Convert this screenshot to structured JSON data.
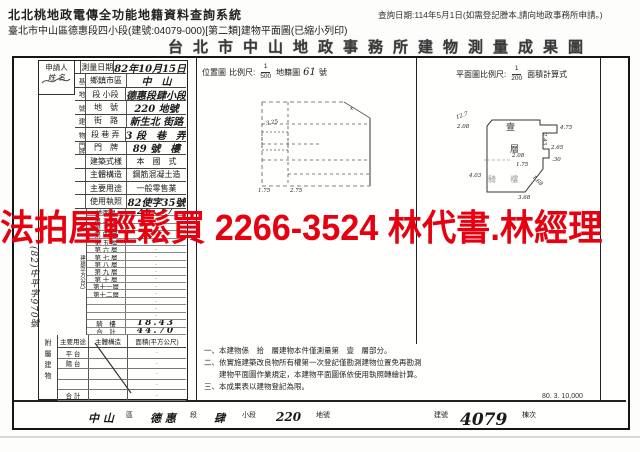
{
  "app": {
    "system_title": "北北桃地政電傳全功能地籍資料查詢系統",
    "query_date": "查詢日期:114年5月1日(如需登記謄本,請向地政事務所申請。)",
    "doc_path": "臺北市中山區德惠段四小段(建號:04079-000)[第二類]建物平面圖(已縮小列印)"
  },
  "overlay": {
    "text": "法拍屋輕鬆買 2266-3524 林代書.林經理",
    "color": "#e60010"
  },
  "document": {
    "title": "台北市中山地政事務所建物測量成果圖",
    "applicant_label": "申請人",
    "applicant_name_label": "姓 名",
    "survey_rows": [
      {
        "group": "",
        "label": "測量日期",
        "value": "82年10月15日",
        "hw": true
      },
      {
        "group": "基",
        "label": "鄉鎮市區",
        "value": "中　山",
        "hw": true
      },
      {
        "group": "地",
        "label": "段 小段",
        "value": "德惠段肆小段",
        "hw": true
      },
      {
        "group": "號",
        "label": "地　號",
        "value": "220 地號",
        "hw": true
      },
      {
        "group": "建",
        "label": "街　路",
        "value": "新生北 街路",
        "hw": true
      },
      {
        "group": "物",
        "label": "段 巷 弄",
        "value": "3 段　巷　弄",
        "hw": true
      },
      {
        "group": "門牌",
        "label": "門　牌",
        "value": "89 號　樓",
        "hw": true
      },
      {
        "group": "",
        "label": "建築式樣",
        "value": "本　國　式",
        "hw": false
      },
      {
        "group": "",
        "label": "主體構造",
        "value": "鋼筋混凝土造",
        "hw": false
      },
      {
        "group": "",
        "label": "主要用途",
        "value": "一般零售業",
        "hw": false
      },
      {
        "group": "",
        "label": "使用執照",
        "value": "82使字35號",
        "hw": true
      }
    ],
    "area_section": {
      "unit_label": "建 積(平方公尺)",
      "rows": [
        {
          "label": "地面層",
          "value": "26.27",
          "hw": true
        },
        {
          "label": "第 二 層",
          "value": "·"
        },
        {
          "label": "第 三 層",
          "value": "·"
        },
        {
          "label": "第 四 層",
          "value": "·"
        },
        {
          "label": "第 五 層",
          "value": "·"
        },
        {
          "label": "第 六 層",
          "value": "·"
        },
        {
          "label": "第 七 層",
          "value": "·"
        },
        {
          "label": "第 八 層",
          "value": "·"
        },
        {
          "label": "第 九 層",
          "value": "·"
        },
        {
          "label": "第 十 層",
          "value": "·"
        },
        {
          "label": "第十一層",
          "value": "·"
        },
        {
          "label": "第十二層",
          "value": "·"
        },
        {
          "label": "",
          "value": "·"
        },
        {
          "label": "",
          "value": "·"
        },
        {
          "label": "",
          "value": "·"
        },
        {
          "label": "騎　樓",
          "value": "18.43",
          "hw": true
        },
        {
          "label": "合　計",
          "value": "44.70",
          "hw": true
        }
      ]
    },
    "margin_note": "(82)中平字970號",
    "attachment": {
      "side_label": "附屬建物",
      "headers": [
        "主要用途",
        "主體構造",
        "面積(平方公尺)"
      ],
      "rows": [
        {
          "label": "平 台",
          "value": "·"
        },
        {
          "label": "陽 台",
          "value": "·"
        },
        {
          "label": "",
          "value": "·"
        },
        {
          "label": "",
          "value": "·"
        },
        {
          "label": "合 計",
          "value": "·"
        }
      ]
    },
    "location_map": {
      "label": "位置圖",
      "scale_label": "比例尺:",
      "scale_num": "1",
      "scale_den": "500",
      "sheet_label": "地籍圖",
      "sheet_no": "61",
      "sheet_suffix": "號",
      "dims": [
        {
          "t": "1.75",
          "x": 0,
          "y": 94,
          "r": 0
        },
        {
          "t": "2.75",
          "x": 32,
          "y": 94,
          "r": 0
        },
        {
          "t": "3.25",
          "x": 8,
          "y": 26,
          "r": -10
        },
        {
          "t": "x",
          "x": 92,
          "y": 12,
          "r": 0
        }
      ]
    },
    "floor_plan": {
      "header_label": "平面圖比例尺:",
      "scale_num": "1",
      "scale_den": "200",
      "header_suffix": "面積計算式",
      "label_top": "壹",
      "label_mid": "層",
      "label_arcade": "騎 樓",
      "dims": [
        {
          "t": "12.7",
          "x": -16,
          "y": 1,
          "r": -20
        },
        {
          "t": "2.08",
          "x": -15,
          "y": 12,
          "r": 0
        },
        {
          "t": "4.75",
          "x": 88,
          "y": 13,
          "r": 0
        },
        {
          "t": "2.43",
          "x": 66,
          "y": 24,
          "r": 90
        },
        {
          "t": "2.65",
          "x": 79,
          "y": 33,
          "r": 0
        },
        {
          "t": ".30",
          "x": 80,
          "y": 45,
          "r": 0
        },
        {
          "t": "2.08",
          "x": 40,
          "y": 41,
          "r": 0
        },
        {
          "t": "1.75",
          "x": 44,
          "y": 50,
          "r": 0
        },
        {
          "t": "4.03",
          "x": -3,
          "y": 61,
          "r": 0
        },
        {
          "t": "1.68",
          "x": 59,
          "y": 66,
          "r": 45
        },
        {
          "t": "3.68",
          "x": 46,
          "y": 83,
          "r": 0
        }
      ]
    },
    "notes": [
      "一、本建物係　拾　層建物本件僅測量第　壹　層部分。",
      "二、依實施建築改良物所有權第一次登記僅勘測建物位置免再勘測",
      "　　建物平面圖作業規定，本建物平面圖係依使用執照轉繪計算。",
      "三、本成果表以建物登記為限。"
    ],
    "print_code": "80. 3. 10,000",
    "footer_items": [
      {
        "t": "中 山",
        "x": 74,
        "size": 11,
        "hw": true
      },
      {
        "t": "區",
        "x": 112,
        "size": 7,
        "hw": false
      },
      {
        "t": "德 惠",
        "x": 136,
        "size": 11,
        "hw": true
      },
      {
        "t": "段",
        "x": 176,
        "size": 7,
        "hw": false
      },
      {
        "t": "肆",
        "x": 200,
        "size": 11,
        "hw": true
      },
      {
        "t": "小段",
        "x": 228,
        "size": 7,
        "hw": false
      },
      {
        "t": "220",
        "x": 262,
        "size": 12,
        "hw": true
      },
      {
        "t": "地號",
        "x": 302,
        "size": 7,
        "hw": false
      },
      {
        "t": "建號",
        "x": 420,
        "size": 7,
        "hw": false
      },
      {
        "t": "4079",
        "x": 446,
        "size": 17,
        "hw": true
      },
      {
        "t": "棟次",
        "x": 508,
        "size": 7,
        "hw": false
      }
    ]
  }
}
